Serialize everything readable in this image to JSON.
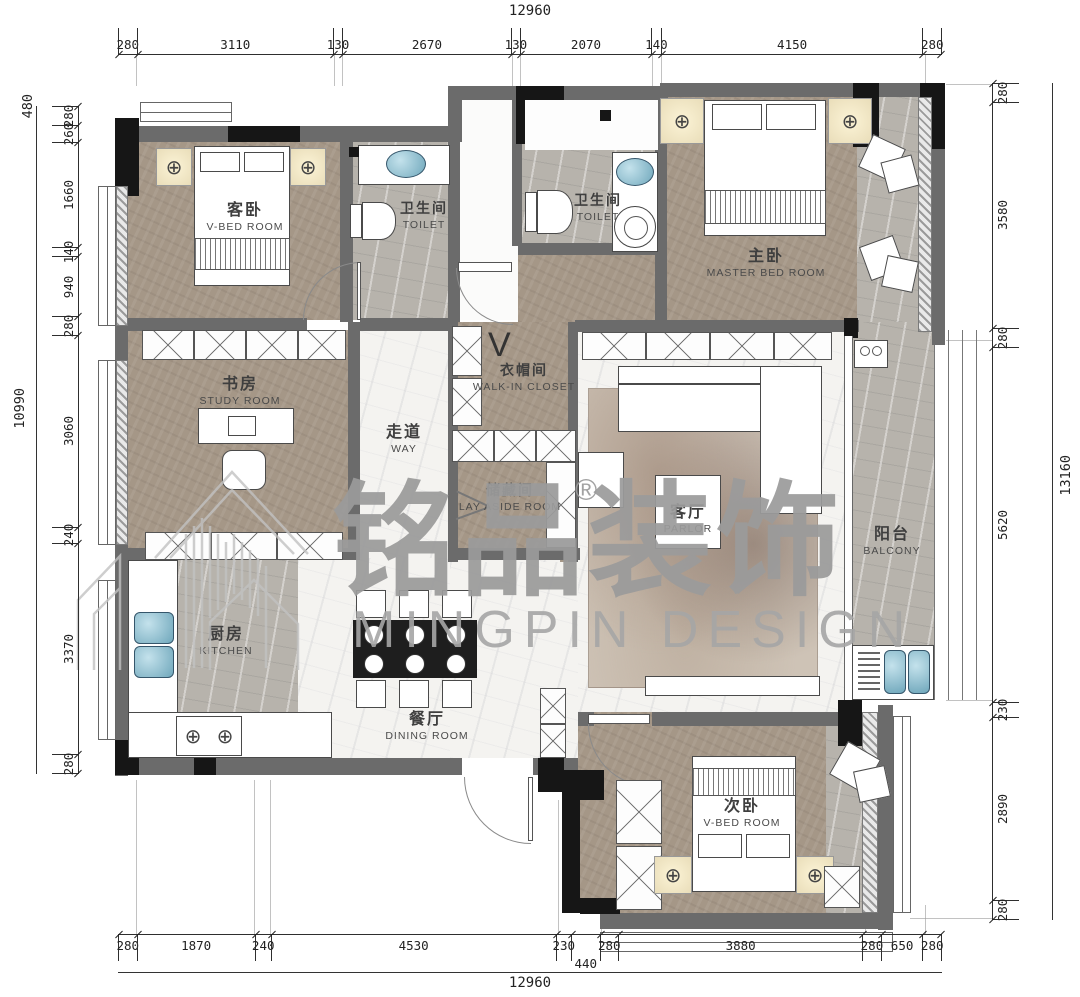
{
  "drawing": {
    "watermark_cn": "铭品装饰",
    "registered_mark": "®",
    "watermark_en": "MINGPIN DESIGN"
  },
  "rooms": {
    "guest_bed": {
      "cn": "客卧",
      "en": "V-BED ROOM"
    },
    "toilet1": {
      "cn": "卫生间",
      "en": "TOILET"
    },
    "toilet2": {
      "cn": "卫生间",
      "en": "TOILET"
    },
    "master_bed": {
      "cn": "主卧",
      "en": "MASTER BED ROOM"
    },
    "study": {
      "cn": "书房",
      "en": "STUDY ROOM"
    },
    "way": {
      "cn": "走道",
      "en": "WAY"
    },
    "closet": {
      "cn": "衣帽间",
      "en": "WALK-IN CLOSET"
    },
    "storage": {
      "cn": "储藏间",
      "en": "LAY ASIDE ROOM"
    },
    "living": {
      "cn": "客厅",
      "en": "PARLOR"
    },
    "balcony": {
      "cn": "阳台",
      "en": "BALCONY"
    },
    "kitchen": {
      "cn": "厨房",
      "en": "KITCHEN"
    },
    "dining": {
      "cn": "餐厅",
      "en": "DINING ROOM"
    },
    "second_bed": {
      "cn": "次卧",
      "en": "V-BED ROOM"
    }
  },
  "dimensions": {
    "top": {
      "total": "12960",
      "segments": [
        280,
        3110,
        130,
        2670,
        130,
        2070,
        140,
        4150,
        280
      ]
    },
    "bottom": {
      "total": "12960",
      "segments": [
        280,
        1870,
        240,
        4530,
        230,
        440,
        280,
        3880,
        280,
        650,
        280
      ]
    },
    "left": {
      "total": "10990",
      "outer": "480",
      "segments": [
        280,
        260,
        1660,
        140,
        940,
        280,
        3060,
        240,
        3370,
        280
      ]
    },
    "right": {
      "total": "13160",
      "segments": [
        280,
        3580,
        280,
        5620,
        230,
        2890,
        280
      ]
    }
  },
  "colors": {
    "wall": "#6b6b6b",
    "wall_dark": "#161616",
    "floor_wood": "#a59787",
    "floor_marble_gray": "#b7b3ac",
    "floor_marble_white": "#f4f3f0",
    "sink_blue": "#7fb5c6",
    "watermark_gray": "#9b9b9b",
    "dim_text": "#222222"
  }
}
